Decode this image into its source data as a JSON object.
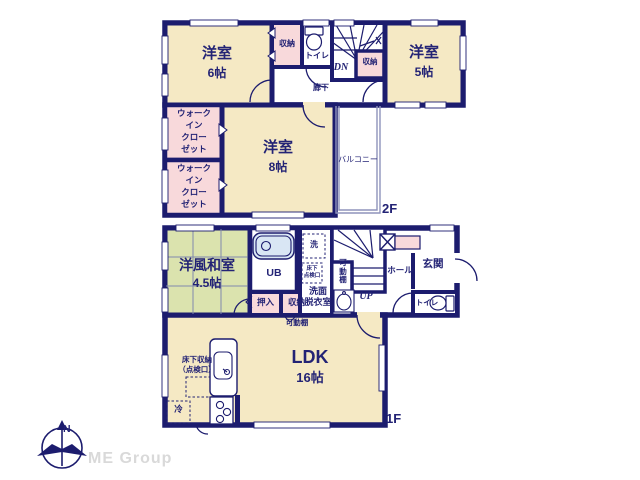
{
  "colors": {
    "wall_navy": "#1c1c6e",
    "text_navy": "#232375",
    "room_cream": "#f5e9c4",
    "closet_pink": "#f8d9db",
    "tatami_green": "#dbe3ae",
    "bath_blue": "#d9e6f4",
    "logo_gray": "#d9d9d9"
  },
  "floor2": {
    "label": "2F",
    "room_yoshitsu6": {
      "name": "洋室",
      "size": "6帖"
    },
    "storage_top": "収納",
    "toilet": "トイレ",
    "stairs_dn": "DN",
    "storage_mid": "収納",
    "hallway": "廊下",
    "room_yoshitsu5": {
      "name": "洋室",
      "size": "5帖"
    },
    "wic_lines": [
      "ウォーク",
      "イン",
      "クロー",
      "ゼット"
    ],
    "room_yoshitsu8": {
      "name": "洋室",
      "size": "8帖"
    },
    "balcony": "バルコニー"
  },
  "floor1": {
    "label": "1F",
    "room_washitsu": {
      "name": "洋風和室",
      "size": "4.5帖"
    },
    "unit_bath": "UB",
    "laundry": "洗",
    "underfloor_hatch_lines": [
      "床下",
      "点検口"
    ],
    "washroom_lines": [
      "洗面",
      "脱衣室"
    ],
    "movable_shelf_stairs": "可動棚",
    "stairs_up": "UP",
    "hall": "ホール",
    "entrance": "玄関",
    "toilet": "トイレ",
    "closet_oshiire": "押入",
    "closet_shuno": "収納",
    "movable_shelf_ldk": "可動棚",
    "room_ldk": {
      "name": "LDK",
      "size": "16帖"
    },
    "underfloor_storage_lines": [
      "床下収納",
      "（点検口）"
    ],
    "refrigerator": "冷"
  },
  "compass": {
    "north": "N"
  },
  "logo": "ME Group"
}
